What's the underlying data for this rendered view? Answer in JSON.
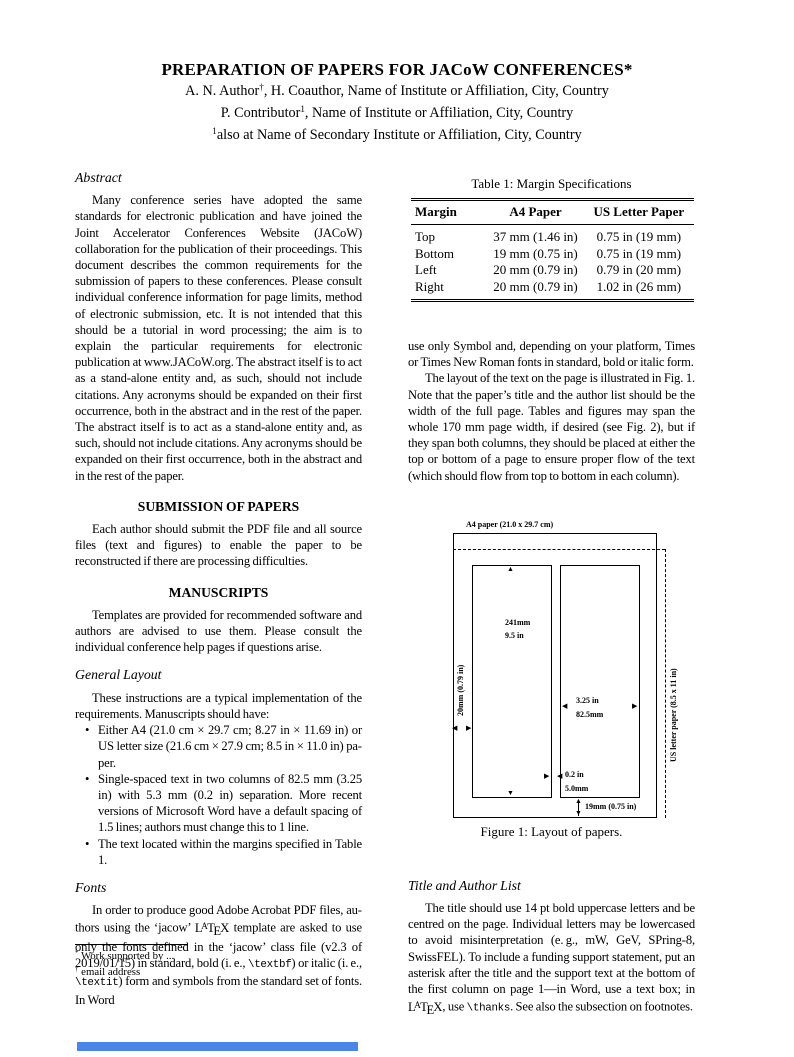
{
  "page": {
    "title": "PREPARATION OF PAPERS FOR JACoW CONFERENCES*",
    "authors": [
      {
        "segments": [
          {
            "t": "A. N. Author"
          },
          {
            "t": "†",
            "sup": true
          },
          {
            "t": ", H. Coauthor, Name of Institute or Affiliation, City, Country"
          }
        ]
      },
      {
        "segments": [
          {
            "t": "P. Contributor"
          },
          {
            "t": "1",
            "sup": true
          },
          {
            "t": ", Name of Institute or Affiliation, City, Country"
          }
        ]
      },
      {
        "segments": [
          {
            "t": "1",
            "sup": true
          },
          {
            "t": "also at Name of Secondary Institute or Affiliation, City, Country"
          }
        ]
      }
    ]
  },
  "left_column": {
    "abstract": {
      "heading": "Abstract",
      "text": "Many conference series have adopted the same standards for electronic publication and have joined the Joint Accel­erator Conferences Website (JACoW) collaboration for the publication of their proceedings. This document describes the common requirements for the submission of papers to these conferences. Please consult individual conference in­formation for page limits, method of electronic submission, etc. It is not intended that this should be a tutorial in word processing; the aim is to explain the particular requirements for electronic publication at www.JACoW.org. The abstract itself is to act as a stand-alone entity and, as such, should not include citations. Any acronyms should be expanded on their first occurrence, both in the abstract and in the rest of the paper. The abstract itself is to act as a stand-alone entity and, as such, should not include citations. Any acronyms should be expanded on their first occurrence, both in the abstract and in the rest of the paper."
    },
    "submission": {
      "heading": "SUBMISSION OF PAPERS",
      "text": "Each author should submit the PDF file and all source files (text and figures) to enable the paper to be reconstructed if there are processing difficulties."
    },
    "manuscripts": {
      "heading": "MANUSCRIPTS",
      "text": "Templates are provided for recommended software and au­thors are advised to use them. Please consult the individual conference help pages if questions arise."
    },
    "general_layout": {
      "heading": "General Layout",
      "intro": "These instructions are a typical implementation of the requirements. Manuscripts should have:",
      "bullets": [
        {
          "text": "Either A4 (21.0 cm × 29.7 cm; 8.27 in × 11.69 in) or US letter size (21.6 cm × 27.9 cm; 8.5 in × 11.0 in) pa­per."
        },
        {
          "text": "Single-spaced text in two columns of 82.5 mm (3.25 in) with 5.3 mm (0.2 in) separation. More recent versions of Microsoft Word have a default spacing of 1.5 lines; authors must change this to 1 line."
        },
        {
          "text": "The text located within the margins specified in Table 1."
        }
      ]
    },
    "fonts": {
      "heading": "Fonts",
      "segments": [
        {
          "t": "In order to produce good Adobe Acrobat PDF files, au­thors using the ‘jacow’ "
        },
        {
          "latex": true
        },
        {
          "t": " template are asked to use only the fonts defined in the ‘jacow’ class file (v2.3 of 2019/01/15) in standard, bold (i. e., "
        },
        {
          "t": "\\textbf",
          "mono": true
        },
        {
          "t": ") or italic (i. e., "
        },
        {
          "t": "\\textit",
          "mono": true
        },
        {
          "t": ") form and symbols from the standard set of fonts. In Word"
        }
      ]
    },
    "footnotes": [
      {
        "marker": "*",
        "text": "Work supported by ..."
      },
      {
        "marker": "†",
        "text": "email address"
      }
    ]
  },
  "right_column": {
    "table": {
      "caption": "Table 1: Margin Specifications",
      "headers": [
        "Margin",
        "A4 Paper",
        "US Letter Paper"
      ],
      "rows": [
        [
          "Top",
          "37 mm (1.46 in)",
          "0.75 in (19 mm)"
        ],
        [
          "Bottom",
          "19 mm (0.75 in)",
          "0.75 in (19 mm)"
        ],
        [
          "Left",
          "20 mm (0.79 in)",
          "0.79 in (20 mm)"
        ],
        [
          "Right",
          "20 mm (0.79 in)",
          "1.02 in (26 mm)"
        ]
      ]
    },
    "para_fonts_continued": "use only Symbol and, depending on your platform, Times or Times New Roman fonts in standard, bold or italic form.",
    "para_layout": "The layout of the text on the page is illustrated in Fig. 1. Note that the paper’s title and the author list should be the width of the full page. Tables and figures may span the whole 170 mm page width, if desired (see Fig. 2), but if they span both columns, they should be placed at either the top or bottom of a page to ensure proper flow of the text (which should flow from top to bottom in each column).",
    "figure": {
      "labels": {
        "a4_label": "A4 paper (21.0 x 29.7 cm)",
        "us_label": "US letter paper (8.5 x 11 in)",
        "col_height_mm": "241mm",
        "col_height_in": "9.5 in",
        "left_margin": "20mm (0.79 in)",
        "col_width_in": "3.25 in",
        "col_width_mm": "82.5mm",
        "gap_in": "0.2 in",
        "gap_mm": "5.0mm",
        "bottom_margin": "19mm (0.75 in)"
      },
      "caption": "Figure 1: Layout of papers."
    },
    "title_author_list": {
      "heading": "Title and Author List",
      "segments": [
        {
          "t": "The title should use 14 pt bold uppercase letters and be centred on the page. Individual letters may be lowercased to avoid misinterpretation (e. g., mW, GeV, SPring-8, Swiss­FEL). To include a funding support statement, put an asterisk after the title and the support text at the bottom of the first column on page 1—in Word, use a text box; in "
        },
        {
          "latex": true
        },
        {
          "t": ", use "
        },
        {
          "t": "\\thanks",
          "mono": true
        },
        {
          "t": ". See also the subsection on footnotes."
        }
      ]
    }
  },
  "accent_bar_color": "#4a86e8"
}
